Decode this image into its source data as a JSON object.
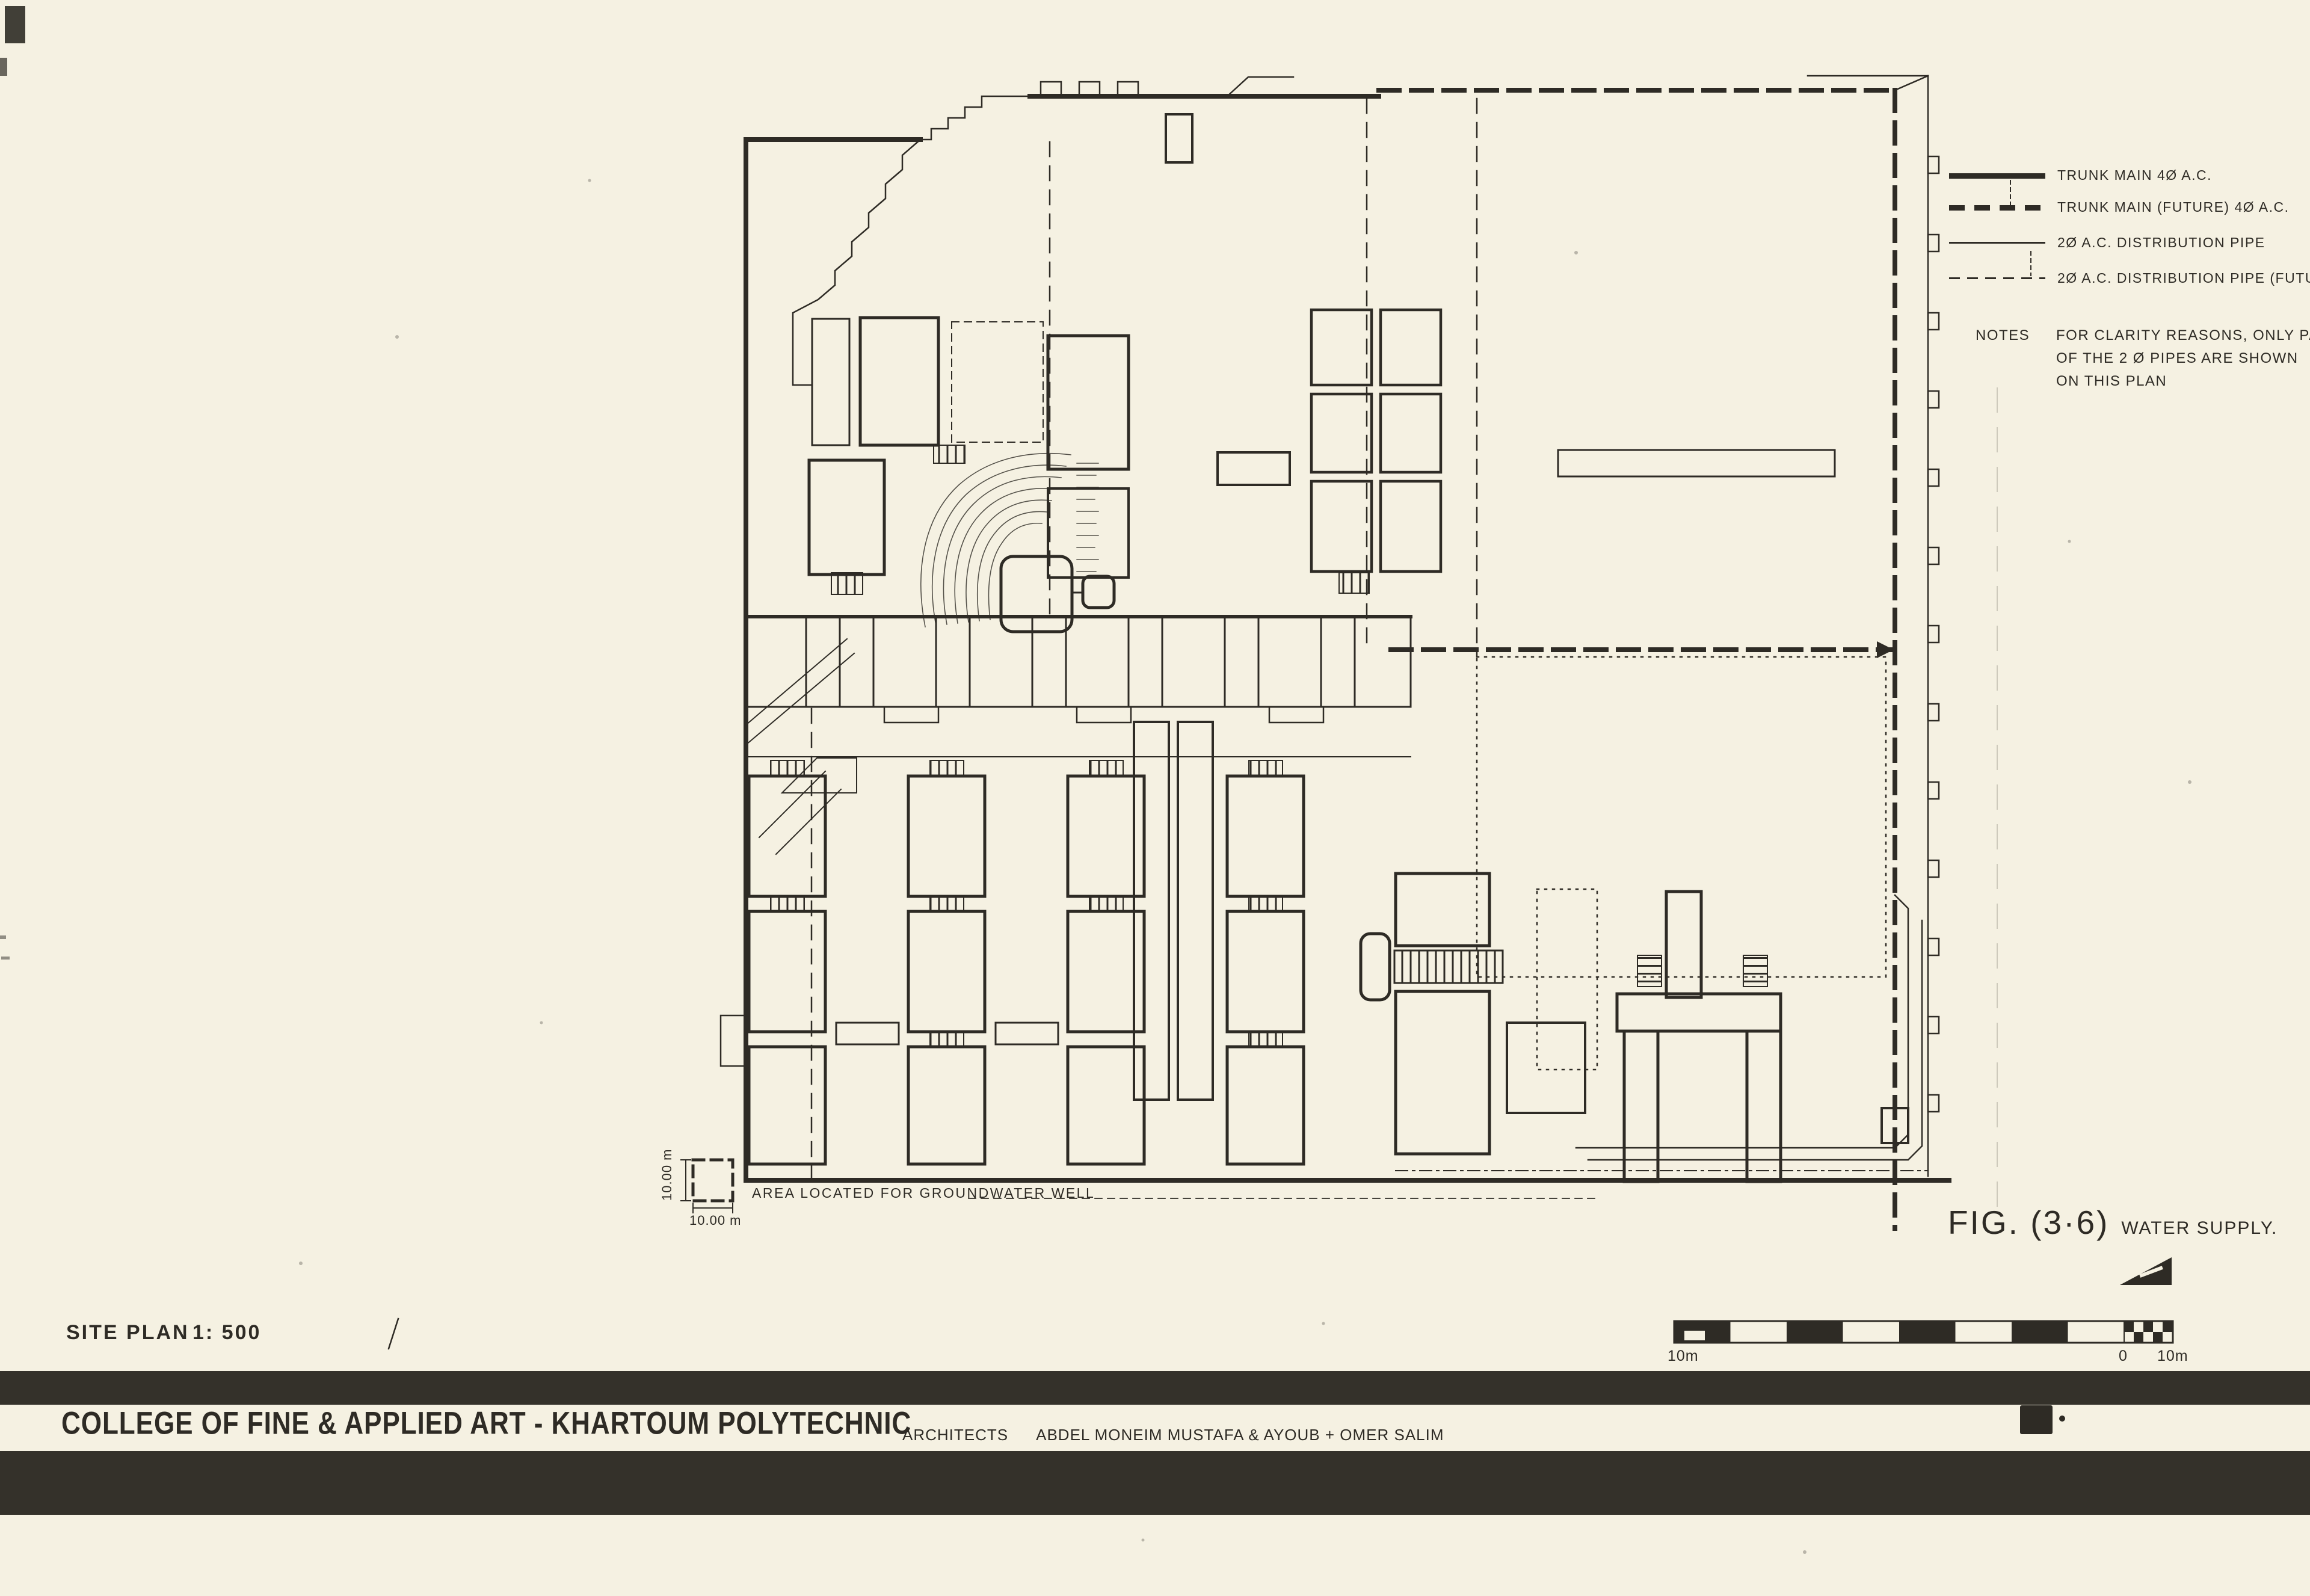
{
  "document": {
    "kind": "scanned architectural site plan drawing"
  },
  "legend": {
    "items": [
      {
        "label": "TRUNK MAIN 4Ø A.C.",
        "line_style": "thick-solid"
      },
      {
        "label": "TRUNK MAIN (FUTURE) 4Ø A.C.",
        "line_style": "thick-dashed"
      },
      {
        "label": "2Ø A.C. DISTRIBUTION PIPE",
        "line_style": "thin-solid"
      },
      {
        "label": "2Ø A.C. DISTRIBUTION PIPE (FUTURE)",
        "line_style": "thin-dashed"
      }
    ]
  },
  "notes": {
    "heading": "NOTES",
    "lines": [
      "FOR CLARITY REASONS, ONLY PART",
      "OF THE 2 Ø PIPES ARE SHOWN",
      "ON THIS PLAN"
    ]
  },
  "figure": {
    "fig_label": "FIG. (3·6)",
    "fig_title": "WATER SUPPLY."
  },
  "plan": {
    "groundwater_label": "AREA LOCATED FOR GROUNDWATER WELL",
    "dim_horizontal": "10.00 m",
    "dim_vertical": "10.00 m"
  },
  "scale_bar": {
    "left_label": "10m",
    "zero_label": "0",
    "right_label": "10m"
  },
  "title_block": {
    "drawing_type": "SITE PLAN",
    "scale_value": "1: 500",
    "project_title": "COLLEGE OF FINE & APPLIED ART - KHARTOUM POLYTECHNIC",
    "architects_label": "ARCHITECTS",
    "architects_names": "ABDEL MONEIM MUSTAFA  &  AYOUB + OMER SALIM"
  },
  "colors": {
    "paper": "#f5f1e2",
    "ink": "#2e2b25",
    "band": "#34312a"
  }
}
